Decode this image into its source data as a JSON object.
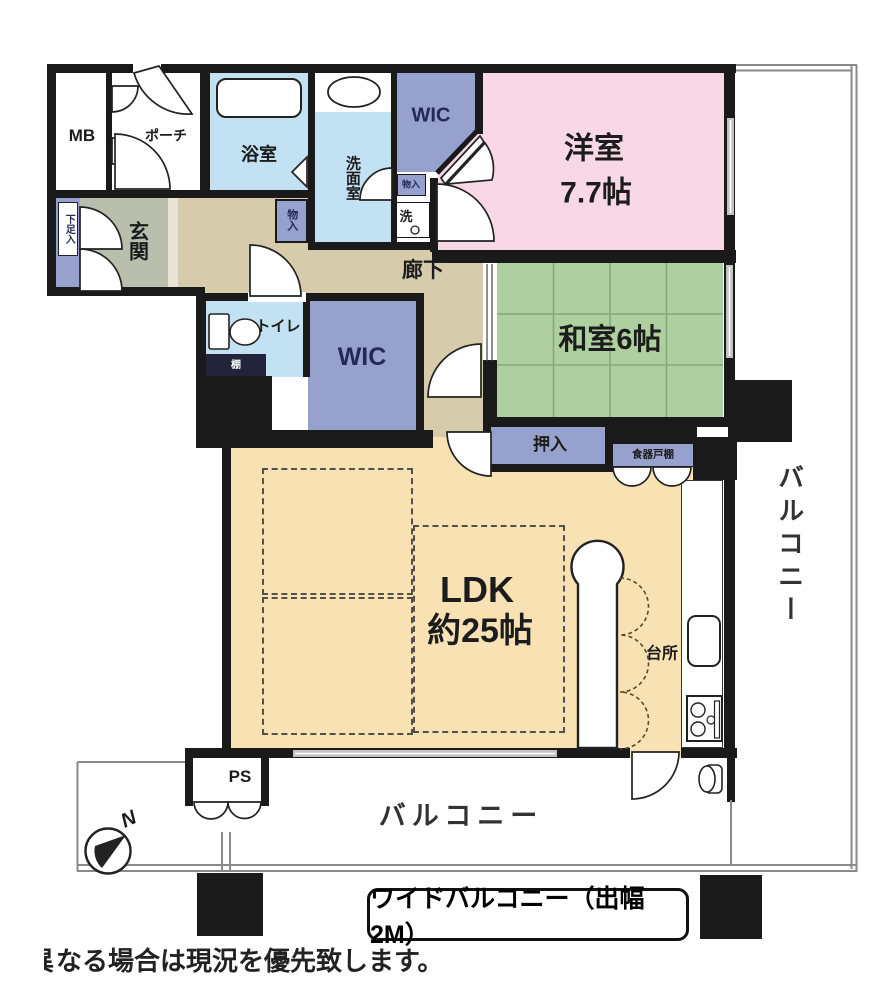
{
  "rooms": {
    "mb": "MB",
    "porch": "ポーチ",
    "bathroom": "浴室",
    "washroom": "洗面室",
    "wic_upper": "WIC",
    "western_name": "洋室",
    "western_size": "7.7帖",
    "shoe_cabinet": "下足入",
    "entrance": "玄関",
    "storage_side": "物入",
    "storage_upper": "物入",
    "washer": "洗",
    "hallway": "廊下",
    "toilet": "トイレ",
    "shelf": "棚",
    "wic_main": "WIC",
    "japanese_room": "和室6帖",
    "futon_closet": "押入",
    "bookshelf": "本棚",
    "dish_cupboard": "食器戸棚",
    "ldk_name": "LDK",
    "ldk_size": "約25帖",
    "kitchen": "台所",
    "pipe_space": "PS"
  },
  "balcony": {
    "right": "バルコニー",
    "bottom": "バルコニー",
    "wide_note": "ワイドバルコニー（出幅2M）"
  },
  "compass": {
    "north": "N"
  },
  "caption": {
    "clipped_char": "異",
    "text": "なる場合は現況を優先致します。"
  },
  "colors": {
    "wall": "#1a1a1a",
    "western_room": "#f8d7e7",
    "japanese_room": "#aecfa0",
    "ldk": "#f8e2b4",
    "hallway": "#d6ccab",
    "entrance": "#b9bfac",
    "wet_area": "#c2e1f3",
    "closet": "#97a1cd",
    "window": "#c2c2c2",
    "tatami_line": "#85a877"
  }
}
